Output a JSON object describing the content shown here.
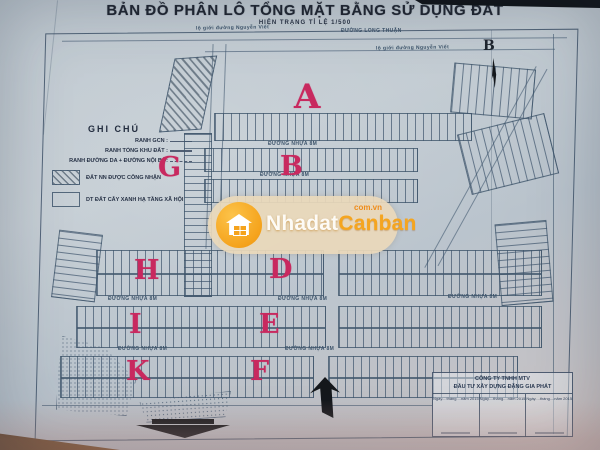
{
  "header": {
    "title": "BẢN ĐỒ PHÂN LÔ TỔNG MẶT BẰNG SỬ DỤNG ĐẤT",
    "subtitle": "HIỆN TRẠNG TỈ LỆ 1/500"
  },
  "legend": {
    "header": "GHI CHÚ",
    "line_items": [
      {
        "label": "RANH GCN :"
      },
      {
        "label": "RANH TỔNG KHU ĐẤT :"
      },
      {
        "label": "RANH ĐƯỜNG DA + ĐƯỜNG NỘI BỘ:"
      }
    ],
    "swatch_items": [
      {
        "label": "ĐẤT NN ĐƯỢC CÔNG NHẬN",
        "pattern": "cross-hatch"
      },
      {
        "label": "DT ĐẤT CÂY XANH HẠ TẦNG XÃ HỘI",
        "pattern": "empty"
      }
    ]
  },
  "zones": {
    "a": "A",
    "b": "B",
    "d": "D",
    "e": "E",
    "f": "F",
    "g": "G",
    "h": "H",
    "i": "I",
    "k": "K"
  },
  "roads": {
    "long_thuan": "ĐƯỜNG LONG THUẬN",
    "nguyen_viet_left": "lộ giới đường Nguyễn Viết",
    "nguyen_viet_right": "lộ giới đường Nguyễn Viết",
    "nhua_label": "ĐƯỜNG NHỰA 8M"
  },
  "compass": {
    "north_label": "B"
  },
  "watermark": {
    "brand_primary": "Nhadat",
    "brand_secondary": "Canban",
    "domain": "com.vn",
    "accent_color": "#f5a31c"
  },
  "title_block": {
    "company_line1": "CÔNG TY TNHH MTV",
    "company_line2": "ĐẦU TƯ XÂY DỰNG ĐẶNG GIA PHÁT",
    "date_columns": [
      "Ngày....tháng....năm 2015",
      "Ngày....tháng....năm 2015",
      "Ngày....tháng....năm 2015"
    ]
  },
  "colors": {
    "zone_letter": "#c8295f",
    "paper": "#bfc9d1",
    "map_line": "#46596e"
  }
}
